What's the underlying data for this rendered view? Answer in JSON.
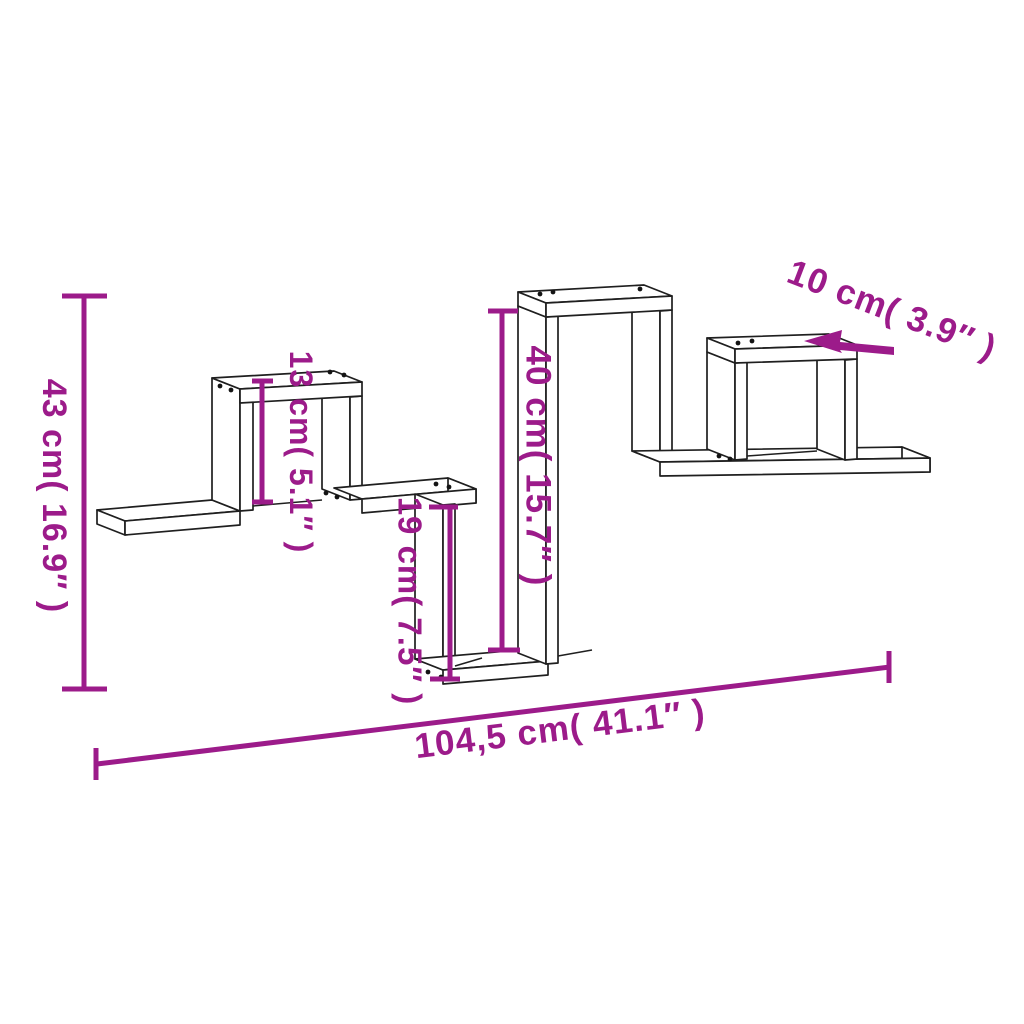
{
  "canvas": {
    "background": "#ffffff"
  },
  "style": {
    "dimension_color": "#9C1B8A",
    "drawing_line_color": "#1f1f1f"
  },
  "diagram": {
    "subject": "wall-mounted zigzag cube shelf dimension drawing",
    "view": "3D line drawing with magenta dimension annotations"
  },
  "labels": {
    "total_height": {
      "text": "43 cm( 16.9″ )",
      "cm": "43",
      "inches": "16.9"
    },
    "cube_height": {
      "text": "13 cm( 5.1″ )",
      "cm": "13",
      "inches": "5.1"
    },
    "mid_section_height": {
      "text": "40 cm( 15.7″ )",
      "cm": "40",
      "inches": "15.7"
    },
    "step_height": {
      "text": "19 cm( 7.5″ )",
      "cm": "19",
      "inches": "7.5"
    },
    "depth": {
      "text": "10 cm( 3.9″ )",
      "cm": "10",
      "inches": "3.9"
    },
    "total_width": {
      "text": "104,5 cm( 41.1″ )",
      "cm": "104,5",
      "inches": "41.1"
    }
  }
}
